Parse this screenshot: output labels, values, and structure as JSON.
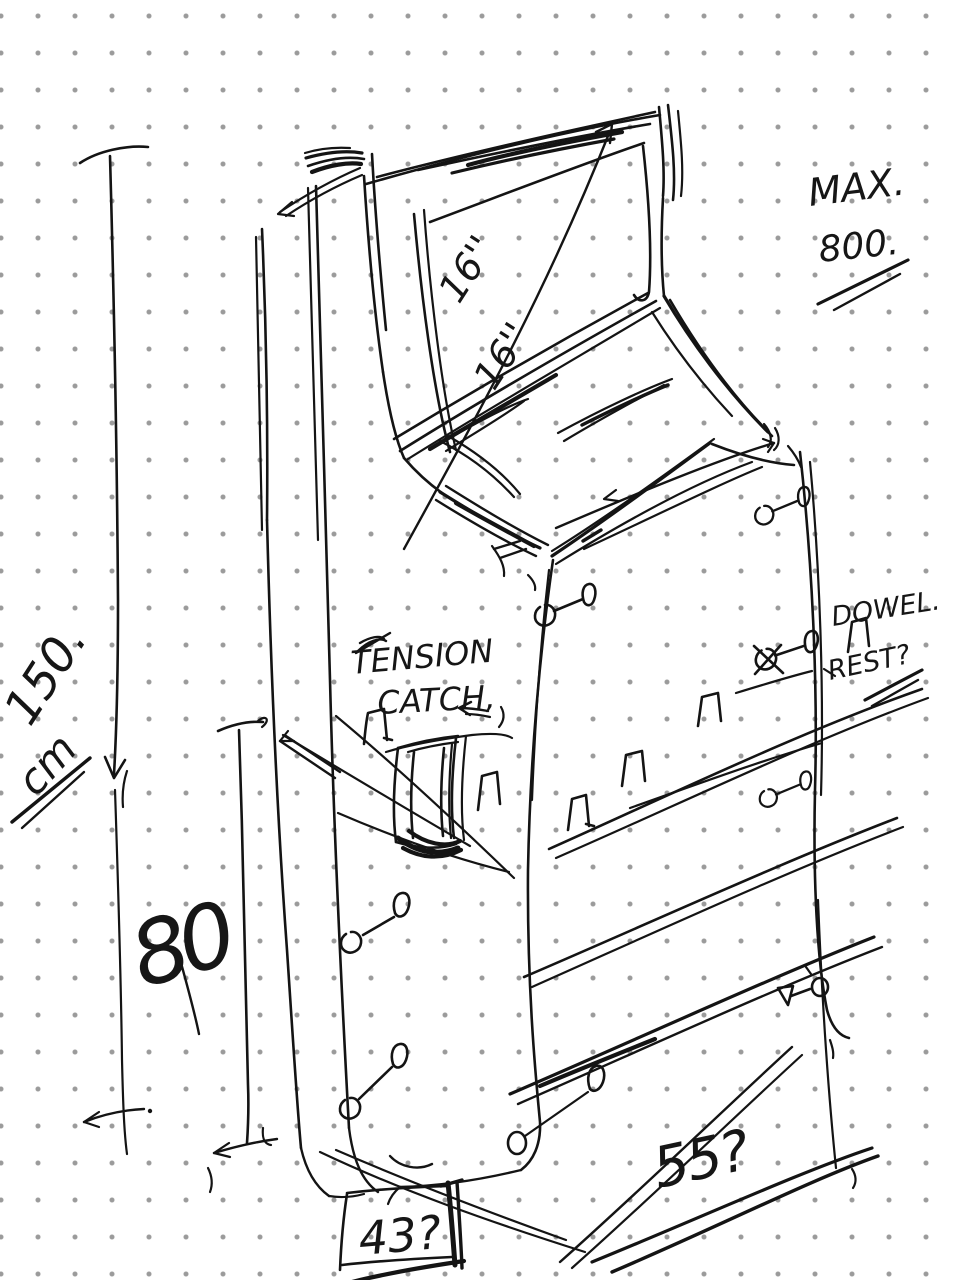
{
  "paper": {
    "background": "#ffffff",
    "dot_color": "#9b9b9b",
    "dot_spacing_px": 37,
    "ink_color": "#141414"
  },
  "annotations": {
    "max_weight": {
      "line1": "MAX.",
      "line2": "800."
    },
    "screen_diagonal": {
      "top": "16''",
      "bottom": "16''"
    },
    "tension_catch": {
      "line1": "TENSION",
      "line2": "CATCH,"
    },
    "dowel_rest": {
      "line1": "DOWEL.",
      "line2": "REST?"
    },
    "overall_height": {
      "value": "150.",
      "unit": "cm"
    },
    "lower_section_height": {
      "value": "80"
    },
    "depth": {
      "value": "55?"
    },
    "base": {
      "value": "43?"
    }
  }
}
